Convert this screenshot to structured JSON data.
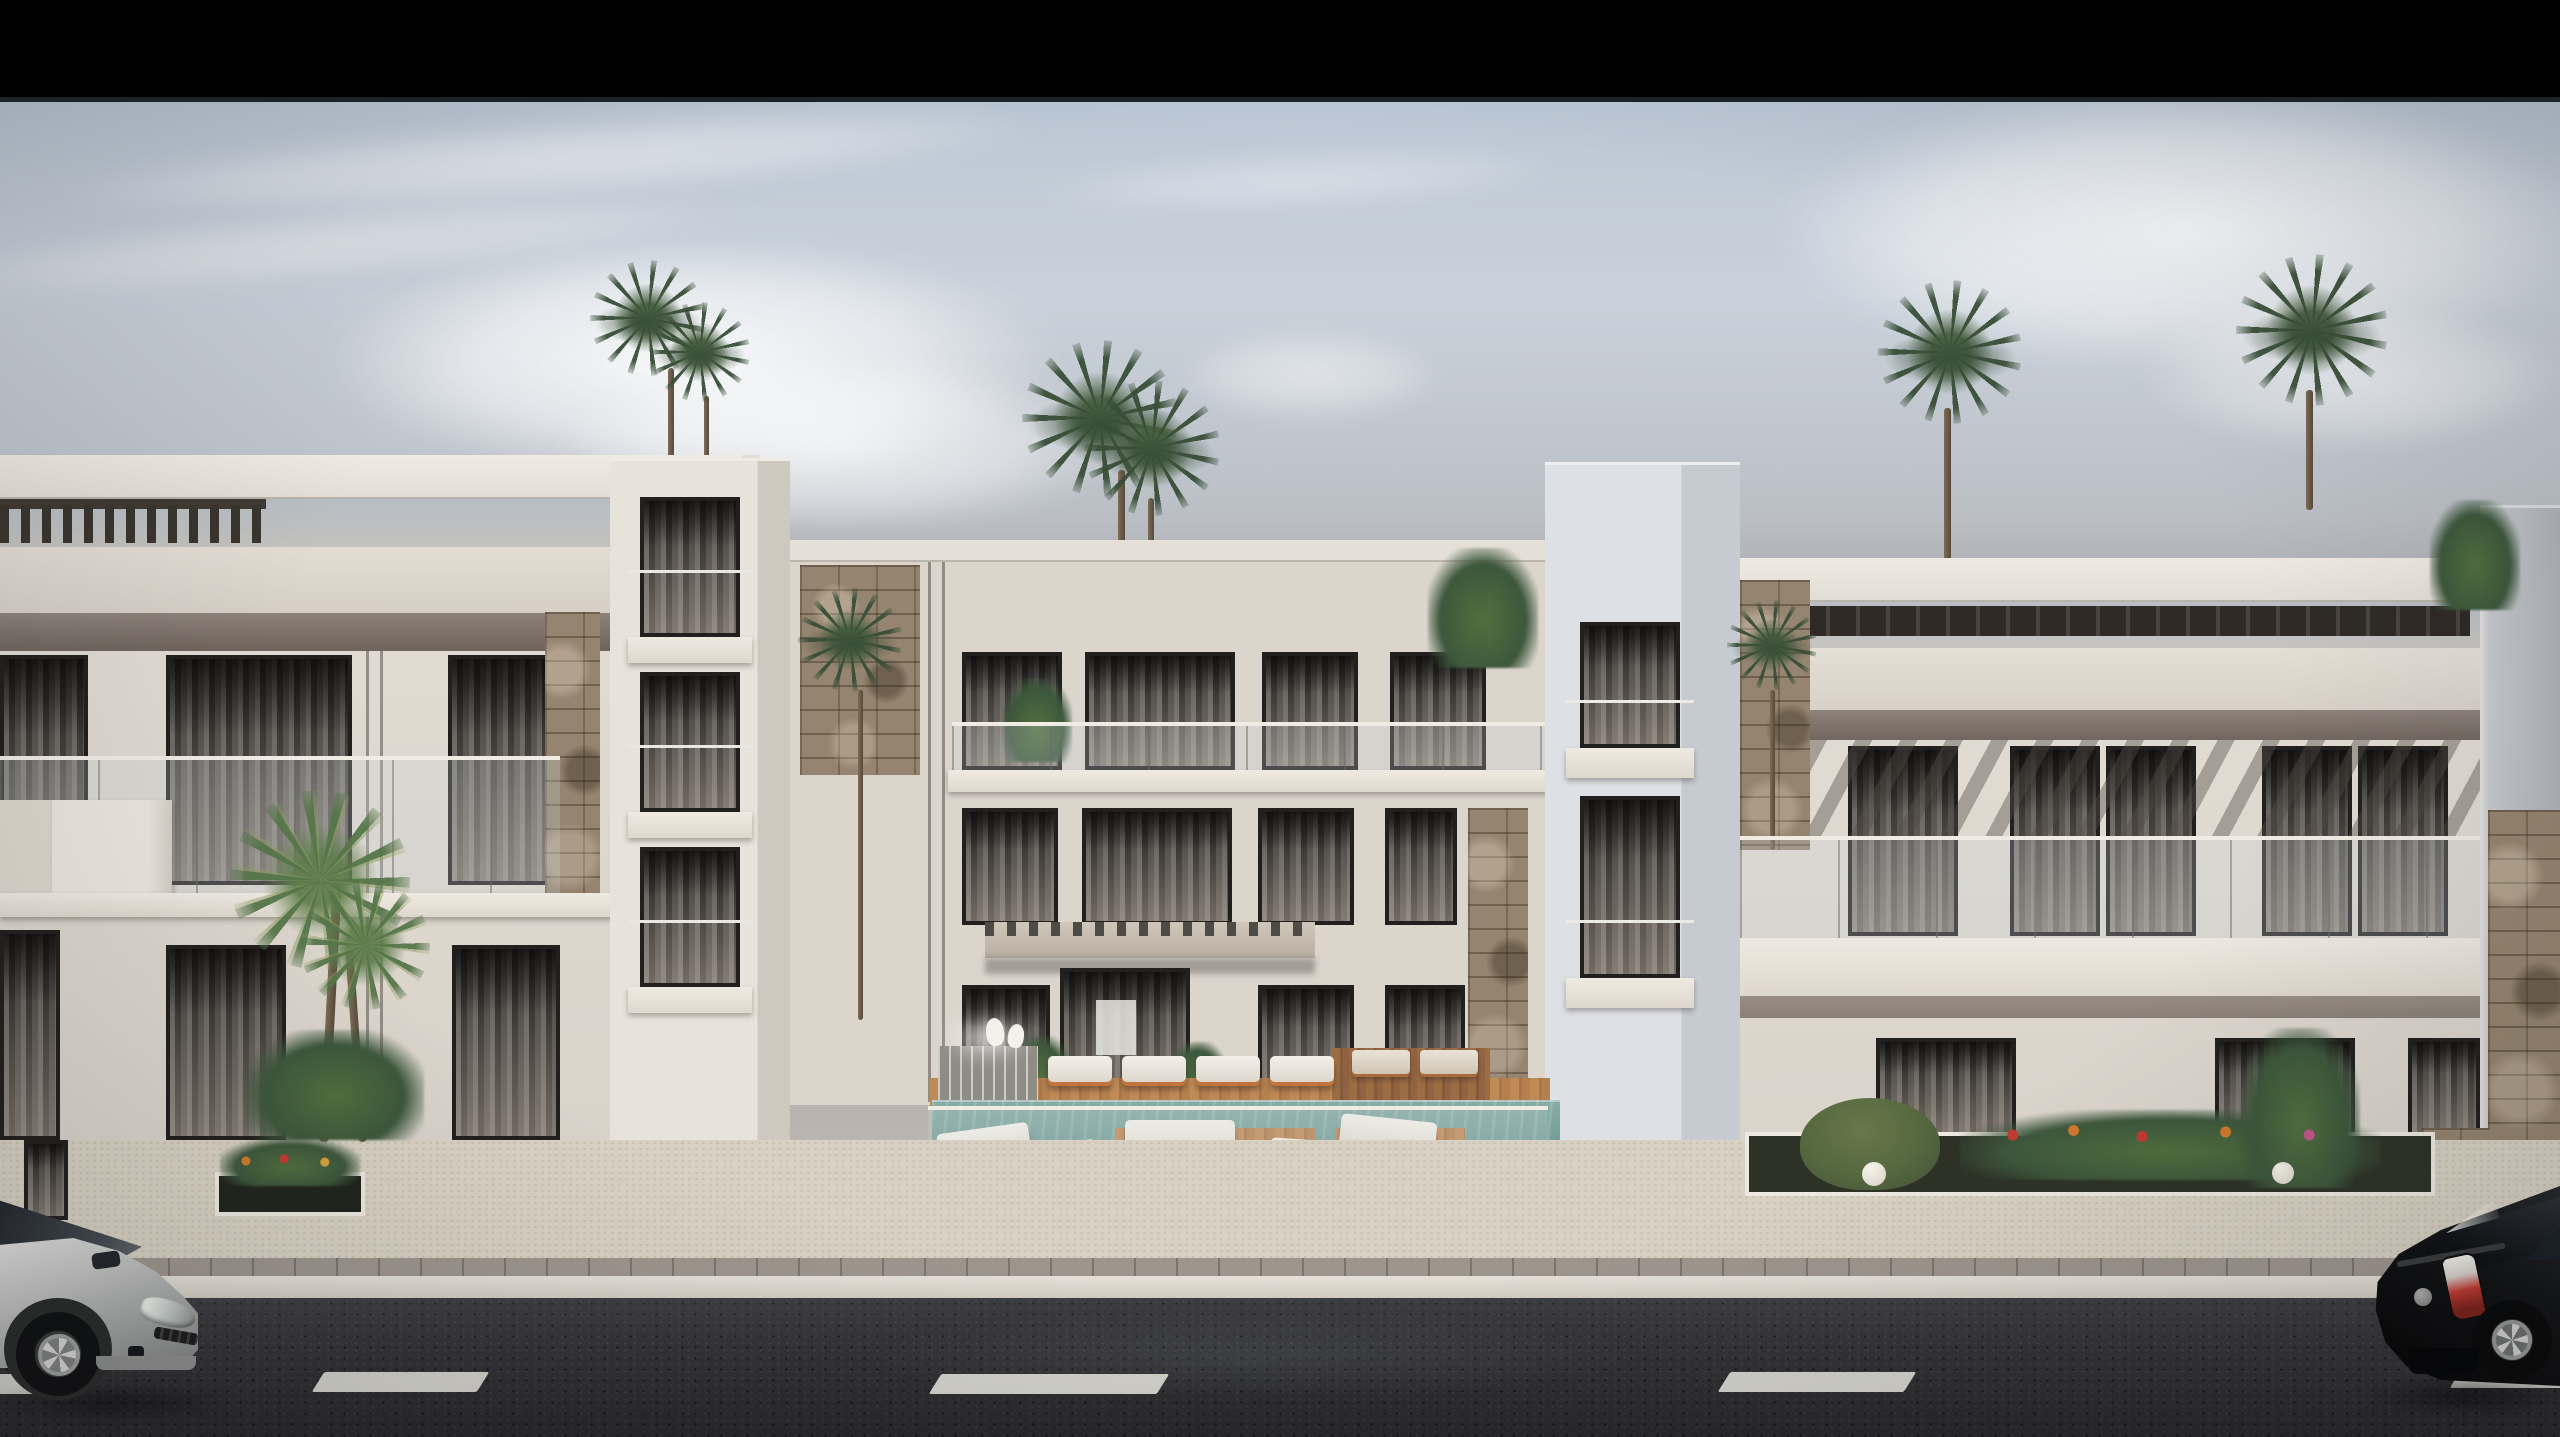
{
  "scene": {
    "type": "architectural-exterior-render",
    "description": "Letterboxed 3D rendering of a modern white three-storey apartment complex with rooftop pergolas, glass balconies, stone accent piers and curtained windows; a central courtyard holds a teal swimming pool with wooden deck islands, white sun loungers, a fountain and swan statues; rooftop and courtyard palm trees; in the foreground a beige sidewalk with flower planters, a dark asphalt road with a white dashed lane line, a silver hatchback entering at the left edge and a black hatchback at the right edge.",
    "letterbox": {
      "top_bar": true,
      "bottom_bar": false,
      "bar_color": "#000000"
    },
    "palette": {
      "sky_top": "#bcc8d5",
      "sky_horizon_haze": "#b3aeaa",
      "cloud_white": "#f4f4f3",
      "facade_light": "#e5dfd6",
      "facade_shadow": "#d6cfc6",
      "soffit_shadow": "#6e645c",
      "tower_cool": "#dde0e4",
      "stone_accent": "#95846f",
      "window_glass": "#2b2926",
      "curtain_sheer": "#cfc8bd",
      "pool_water": "#7aa29c",
      "deck_wood": "#b5804f",
      "lounger_cushion": "#f2efe8",
      "lounger_frame_orange": "#c87838",
      "sidewalk": "#d8d1c3",
      "curb_paver": "#9e968d",
      "asphalt": "#343437",
      "lane_marking": "#dbdad4",
      "silver_car": "#c3c4c2",
      "black_car": "#0a0a0b",
      "palm_green_dark": "#3f5a42",
      "palm_green_light": "#5d7c52",
      "awning_shadow_stripe": "#524c46"
    },
    "objects": {
      "buildings": [
        "left-wing",
        "left-stair-tower",
        "central-block",
        "right-stair-tower",
        "right-wing",
        "right-edge-block"
      ],
      "rooftop_palm_trees": 6,
      "courtyard": {
        "pool": true,
        "wooden_deck_islands": 2,
        "sun_loungers_white": 9,
        "sun_loungers_warm": 2,
        "wooden_stools": 2,
        "fountain": true,
        "swan_statues": 2,
        "glass_pool_fence": true
      },
      "entrance": {
        "canopy_with_dentil_trim": true,
        "glass_doors": true,
        "potted_plants": 2
      },
      "street": {
        "sidewalk_planters": 2,
        "flower_bed_with_bush_and_lamps": true,
        "lane_dashes_visible": 5,
        "vehicles": [
          {
            "type": "hatchback",
            "color": "silver",
            "position": "bottom-left",
            "view": "front-three-quarter"
          },
          {
            "type": "hatchback",
            "color": "black",
            "position": "bottom-right",
            "view": "rear-three-quarter"
          }
        ]
      }
    }
  }
}
